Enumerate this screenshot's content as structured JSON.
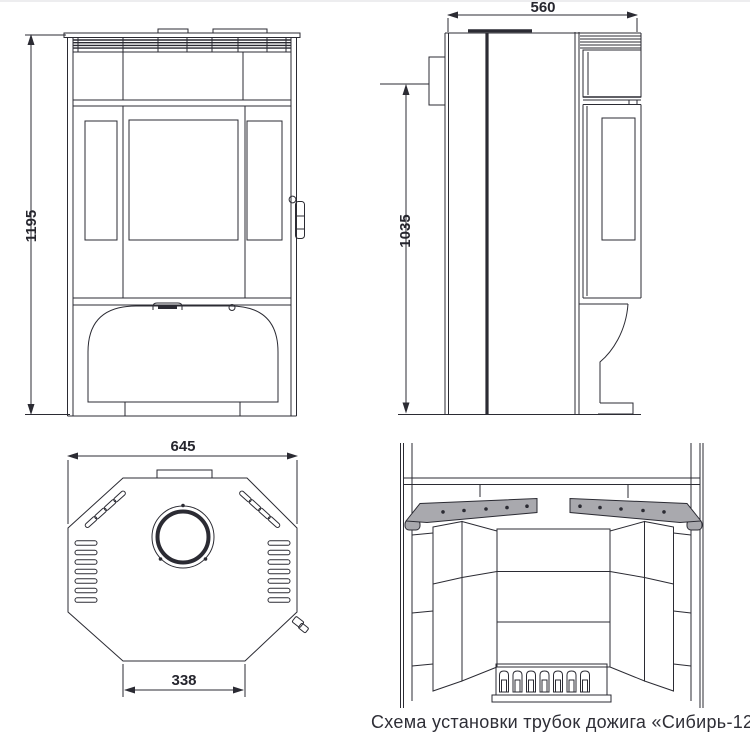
{
  "caption": "Схема установки трубок дожига «Сибирь-12'",
  "dimensions": {
    "front_height": "1195",
    "side_depth": "560",
    "flue_outlet_height": "1035",
    "top_width": "645",
    "base_width": "338"
  },
  "colors": {
    "line": "#2b2b33",
    "tube_fill": "#a9a9ae",
    "background": "#ffffff"
  }
}
